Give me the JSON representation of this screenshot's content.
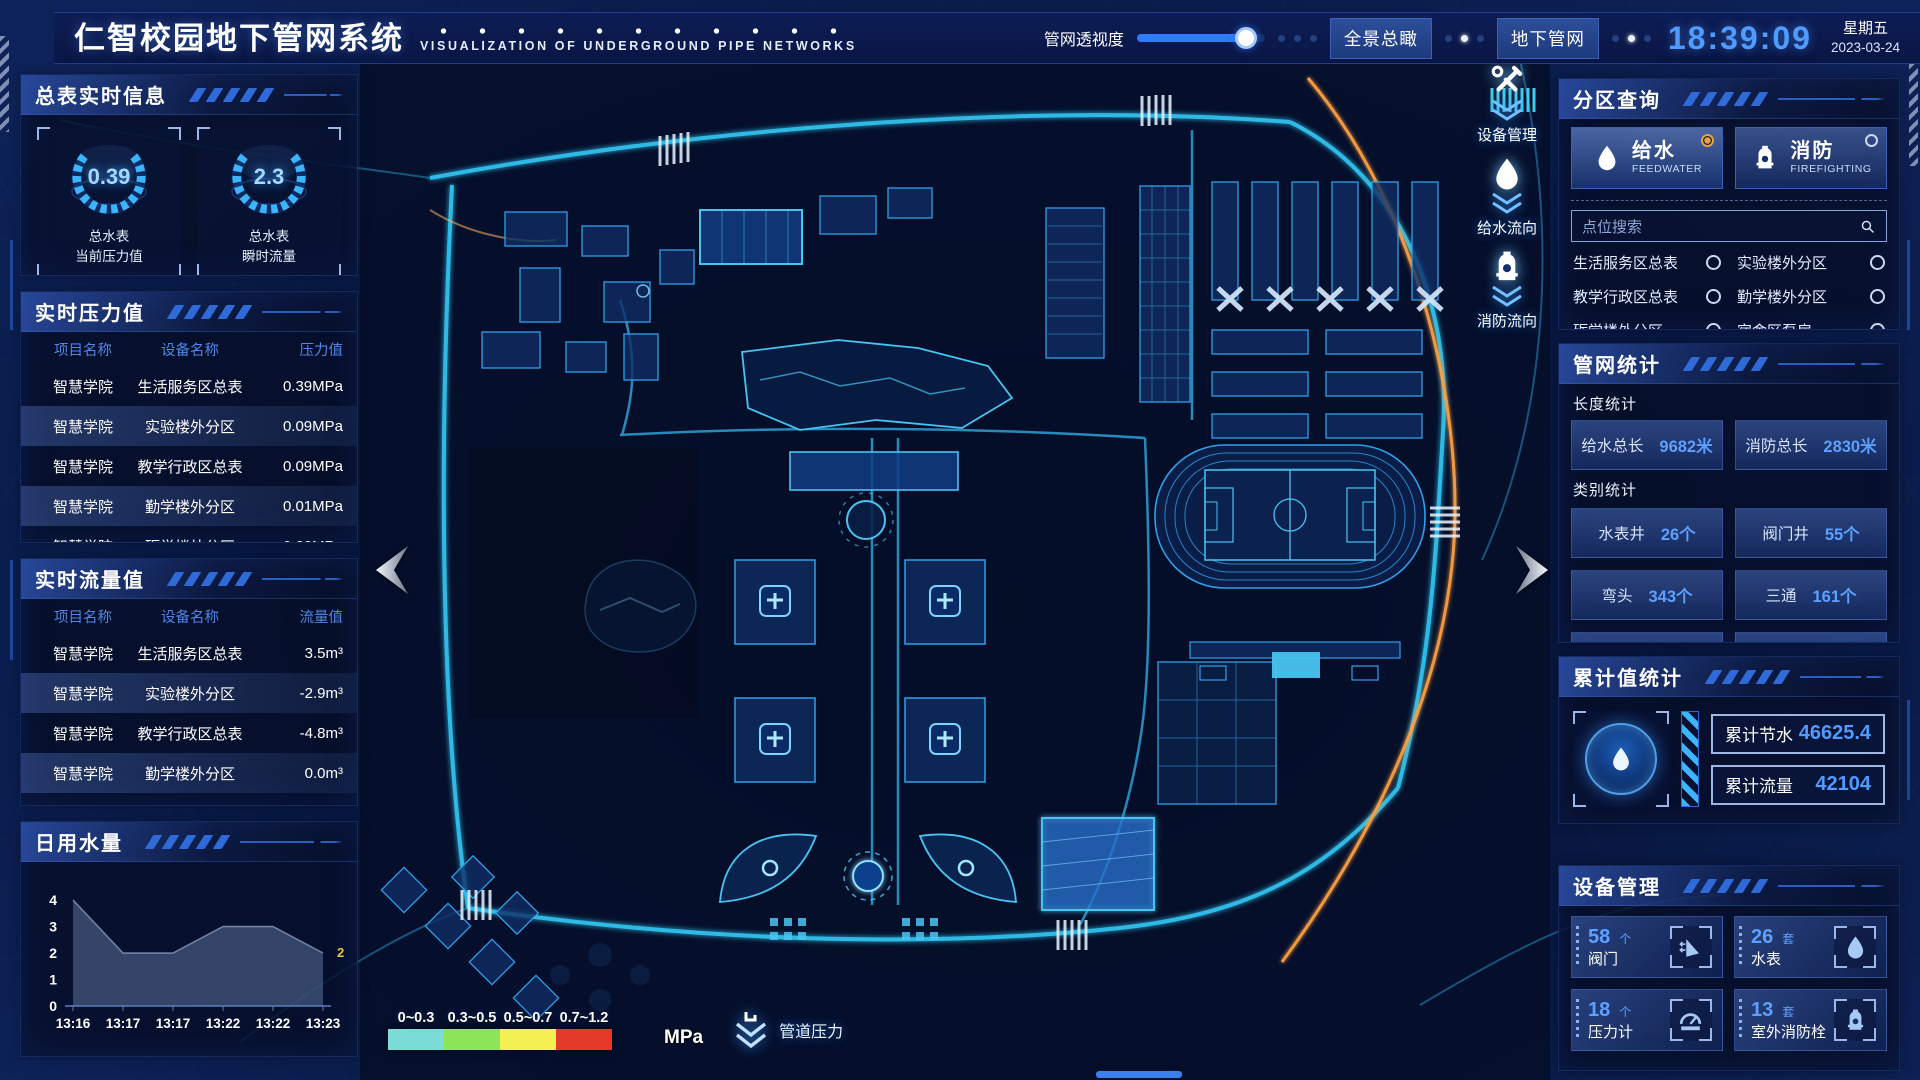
{
  "header": {
    "title": "仁智校园地下管网系统",
    "subtitle": "VISUALIZATION OF UNDERGROUND PIPE NETWORKS",
    "slider_label": "管网透视度",
    "slider_percent": 85,
    "buttons": [
      {
        "label": "全景总瞰"
      },
      {
        "label": "地下管网"
      }
    ],
    "time": "18:39:09",
    "weekday": "星期五",
    "date": "2023-03-24"
  },
  "left": {
    "meters": {
      "title": "总表实时信息",
      "gauges": [
        {
          "value": "0.39",
          "label1": "总水表",
          "label2": "当前压力值"
        },
        {
          "value": "2.3",
          "label1": "总水表",
          "label2": "瞬时流量"
        }
      ]
    },
    "pressure": {
      "title": "实时压力值",
      "headers": [
        "项目名称",
        "设备名称",
        "压力值"
      ],
      "rows": [
        [
          "智慧学院",
          "生活服务区总表",
          "0.39MPa"
        ],
        [
          "智慧学院",
          "实验楼外分区",
          "0.09MPa"
        ],
        [
          "智慧学院",
          "教学行政区总表",
          "0.09MPa"
        ],
        [
          "智慧学院",
          "勤学楼外分区",
          "0.01MPa"
        ],
        [
          "智慧学院",
          "砺学楼外分区",
          "0.00MPa"
        ]
      ]
    },
    "flow": {
      "title": "实时流量值",
      "headers": [
        "项目名称",
        "设备名称",
        "流量值"
      ],
      "rows": [
        [
          "智慧学院",
          "生活服务区总表",
          "3.5m³"
        ],
        [
          "智慧学院",
          "实验楼外分区",
          "-2.9m³"
        ],
        [
          "智慧学院",
          "教学行政区总表",
          "-4.8m³"
        ],
        [
          "智慧学院",
          "勤学楼外分区",
          "0.0m³"
        ],
        [
          "智慧学院",
          "砺学楼外分区",
          "2.3m³"
        ]
      ]
    },
    "daily": {
      "title": "日用水量"
    }
  },
  "chart_data": {
    "type": "area",
    "title": "日用水量",
    "x": [
      "13:16",
      "13:17",
      "13:17",
      "13:22",
      "13:22",
      "13:23"
    ],
    "values": [
      4,
      2,
      2,
      3,
      3,
      2
    ],
    "yticks": [
      0,
      1,
      2,
      3,
      4
    ],
    "ylim": [
      0,
      4
    ],
    "end_label": "2",
    "end_label_color": "#e8c53f",
    "fill_color": "rgba(130,156,202,0.38)"
  },
  "map": {
    "overlay_buttons": [
      {
        "label": "设备管理",
        "icon": "tools-icon"
      },
      {
        "label": "给水流向",
        "icon": "water-drop-icon"
      },
      {
        "label": "消防流向",
        "icon": "hydrant-icon"
      }
    ],
    "legend": {
      "ranges": [
        {
          "label": "0~0.3",
          "color": "#7adcd4"
        },
        {
          "label": "0.3~0.5",
          "color": "#8ce557"
        },
        {
          "label": "0.5~0.7",
          "color": "#f4f052"
        },
        {
          "label": "0.7~1.2",
          "color": "#e33b27"
        }
      ],
      "unit": "MPa",
      "caption": "管道压力"
    }
  },
  "right": {
    "zone_query": {
      "title": "分区查询",
      "tabs": [
        {
          "label": "给水",
          "sub": "FEEDWATER",
          "icon": "water-drop-icon",
          "selected": true
        },
        {
          "label": "消防",
          "sub": "FIREFIGHTING",
          "icon": "hydrant-icon",
          "selected": false
        }
      ],
      "search_placeholder": "点位搜索",
      "options": [
        "生活服务区总表",
        "实验楼外分区",
        "教学行政区总表",
        "勤学楼外分区",
        "砺学楼外分区",
        "宿舍区泵房"
      ]
    },
    "pipe_stats": {
      "title": "管网统计",
      "length_label": "长度统计",
      "length_stats": [
        {
          "label": "给水总长",
          "value": "9682米"
        },
        {
          "label": "消防总长",
          "value": "2830米"
        }
      ],
      "category_label": "类别统计",
      "category_stats": [
        {
          "label": "水表井",
          "value": "26个"
        },
        {
          "label": "阀门井",
          "value": "55个"
        },
        {
          "label": "弯头",
          "value": "343个"
        },
        {
          "label": "三通",
          "value": "161个"
        }
      ]
    },
    "cumulative": {
      "title": "累计值统计",
      "stats": [
        {
          "label": "累计节水",
          "value": "46625.4"
        },
        {
          "label": "累计流量",
          "value": "42104"
        }
      ]
    },
    "devices": {
      "title": "设备管理",
      "cards": [
        {
          "count": "58",
          "unit": "个",
          "label": "阀门",
          "icon": "valve-icon"
        },
        {
          "count": "26",
          "unit": "套",
          "label": "水表",
          "icon": "water-drop-icon"
        },
        {
          "count": "18",
          "unit": "个",
          "label": "压力计",
          "icon": "pressure-gauge-icon"
        },
        {
          "count": "13",
          "unit": "套",
          "label": "室外消防栓",
          "icon": "hydrant-icon"
        }
      ]
    }
  }
}
